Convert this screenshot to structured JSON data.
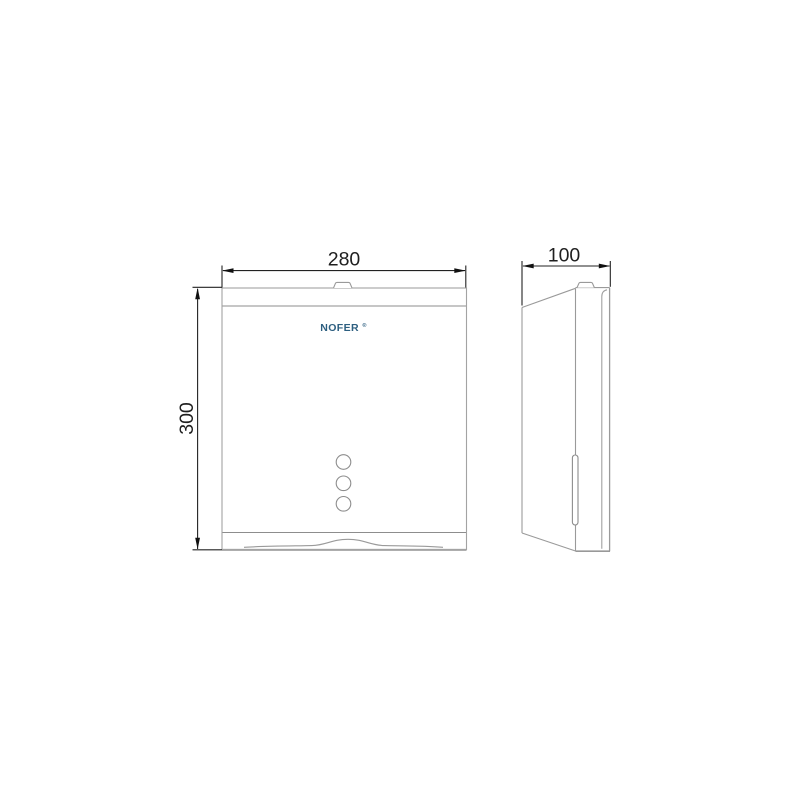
{
  "drawing": {
    "brand": "NOFER",
    "brand_mark": "®",
    "front_view": {
      "width_label": "280",
      "height_label": "300"
    },
    "side_view": {
      "depth_label": "100"
    },
    "colors": {
      "outline": "#9a9a9a",
      "inner_line": "#8d8d8d",
      "dimension": "#1f1f1f",
      "logo": "#2d5f80"
    }
  }
}
